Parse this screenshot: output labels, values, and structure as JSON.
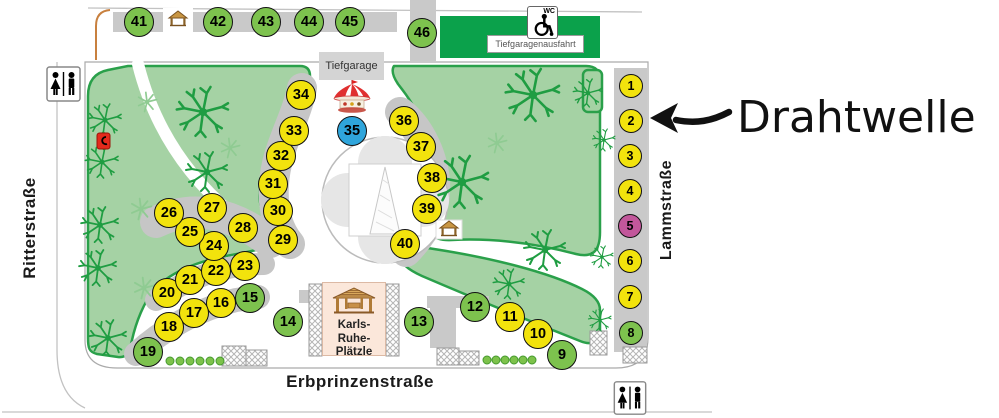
{
  "streets": {
    "left": "Ritterstraße",
    "right": "Lammstraße",
    "bottom": "Erbprinzenstraße"
  },
  "labels": {
    "garage": "Tiefgarage",
    "garage_exit": "Tiefgaragenausfahrt",
    "wc": "WC"
  },
  "square": {
    "line1": "Karls-",
    "line2": "Ruhe-",
    "line3": "Plätzle"
  },
  "annotation": {
    "label": "Drahtwelle",
    "points_to_stall": "2"
  },
  "colors": {
    "yellow": "#F2E30D",
    "green": "#7DC24E",
    "magenta": "#C2579B",
    "blue": "#2FA5DB"
  },
  "stalls": [
    {
      "n": "1",
      "c": "yellow",
      "x": 631,
      "y": 86,
      "r": 12
    },
    {
      "n": "2",
      "c": "yellow",
      "x": 631,
      "y": 121,
      "r": 12
    },
    {
      "n": "3",
      "c": "yellow",
      "x": 630,
      "y": 156,
      "r": 12
    },
    {
      "n": "4",
      "c": "yellow",
      "x": 630,
      "y": 191,
      "r": 12
    },
    {
      "n": "5",
      "c": "magenta",
      "x": 630,
      "y": 226,
      "r": 12
    },
    {
      "n": "6",
      "c": "yellow",
      "x": 630,
      "y": 261,
      "r": 12
    },
    {
      "n": "7",
      "c": "yellow",
      "x": 630,
      "y": 297,
      "r": 12
    },
    {
      "n": "8",
      "c": "green",
      "x": 631,
      "y": 333,
      "r": 12
    },
    {
      "n": "9",
      "c": "green",
      "x": 562,
      "y": 355,
      "r": 15
    },
    {
      "n": "10",
      "c": "yellow",
      "x": 538,
      "y": 334,
      "r": 15
    },
    {
      "n": "11",
      "c": "yellow",
      "x": 510,
      "y": 317,
      "r": 15
    },
    {
      "n": "12",
      "c": "green",
      "x": 475,
      "y": 307,
      "r": 15
    },
    {
      "n": "13",
      "c": "green",
      "x": 419,
      "y": 322,
      "r": 15
    },
    {
      "n": "14",
      "c": "green",
      "x": 288,
      "y": 322,
      "r": 15
    },
    {
      "n": "15",
      "c": "green",
      "x": 250,
      "y": 298,
      "r": 15
    },
    {
      "n": "16",
      "c": "yellow",
      "x": 221,
      "y": 303,
      "r": 15
    },
    {
      "n": "17",
      "c": "yellow",
      "x": 194,
      "y": 313,
      "r": 15
    },
    {
      "n": "18",
      "c": "yellow",
      "x": 169,
      "y": 327,
      "r": 15
    },
    {
      "n": "19",
      "c": "green",
      "x": 148,
      "y": 352,
      "r": 15
    },
    {
      "n": "20",
      "c": "yellow",
      "x": 167,
      "y": 293,
      "r": 15
    },
    {
      "n": "21",
      "c": "yellow",
      "x": 190,
      "y": 280,
      "r": 15
    },
    {
      "n": "22",
      "c": "yellow",
      "x": 216,
      "y": 271,
      "r": 15
    },
    {
      "n": "23",
      "c": "yellow",
      "x": 245,
      "y": 266,
      "r": 15
    },
    {
      "n": "24",
      "c": "yellow",
      "x": 214,
      "y": 246,
      "r": 15
    },
    {
      "n": "25",
      "c": "yellow",
      "x": 190,
      "y": 232,
      "r": 15
    },
    {
      "n": "26",
      "c": "yellow",
      "x": 169,
      "y": 213,
      "r": 15
    },
    {
      "n": "27",
      "c": "yellow",
      "x": 212,
      "y": 208,
      "r": 15
    },
    {
      "n": "28",
      "c": "yellow",
      "x": 243,
      "y": 228,
      "r": 15
    },
    {
      "n": "29",
      "c": "yellow",
      "x": 283,
      "y": 240,
      "r": 15
    },
    {
      "n": "30",
      "c": "yellow",
      "x": 278,
      "y": 211,
      "r": 15
    },
    {
      "n": "31",
      "c": "yellow",
      "x": 273,
      "y": 184,
      "r": 15
    },
    {
      "n": "32",
      "c": "yellow",
      "x": 281,
      "y": 156,
      "r": 15
    },
    {
      "n": "33",
      "c": "yellow",
      "x": 294,
      "y": 131,
      "r": 15
    },
    {
      "n": "34",
      "c": "yellow",
      "x": 301,
      "y": 95,
      "r": 15
    },
    {
      "n": "35",
      "c": "blue",
      "x": 352,
      "y": 131,
      "r": 15
    },
    {
      "n": "36",
      "c": "yellow",
      "x": 404,
      "y": 121,
      "r": 15
    },
    {
      "n": "37",
      "c": "yellow",
      "x": 421,
      "y": 147,
      "r": 15
    },
    {
      "n": "38",
      "c": "yellow",
      "x": 432,
      "y": 178,
      "r": 15
    },
    {
      "n": "39",
      "c": "yellow",
      "x": 427,
      "y": 209,
      "r": 15
    },
    {
      "n": "40",
      "c": "yellow",
      "x": 405,
      "y": 244,
      "r": 15
    },
    {
      "n": "41",
      "c": "green",
      "x": 139,
      "y": 22,
      "r": 15
    },
    {
      "n": "42",
      "c": "green",
      "x": 218,
      "y": 22,
      "r": 15
    },
    {
      "n": "43",
      "c": "green",
      "x": 266,
      "y": 22,
      "r": 15
    },
    {
      "n": "44",
      "c": "green",
      "x": 309,
      "y": 22,
      "r": 15
    },
    {
      "n": "45",
      "c": "green",
      "x": 350,
      "y": 22,
      "r": 15
    },
    {
      "n": "46",
      "c": "green",
      "x": 422,
      "y": 33,
      "r": 15
    }
  ]
}
